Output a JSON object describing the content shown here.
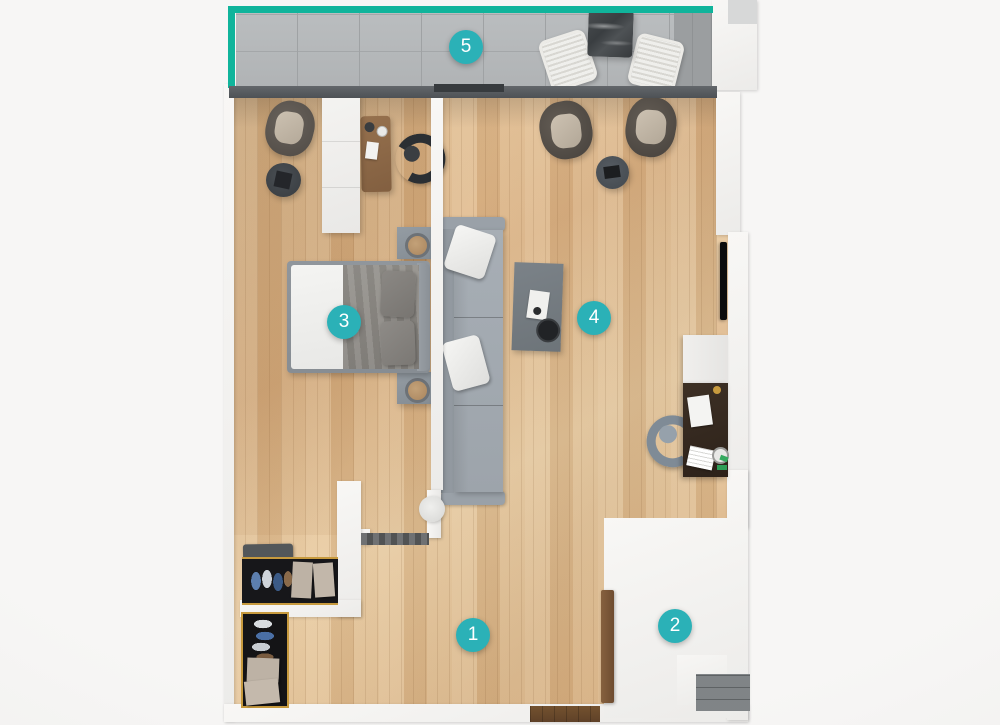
{
  "app": {
    "type": "apartment-floor-plan-render"
  },
  "badges": [
    {
      "number": "1",
      "area": "hallway"
    },
    {
      "number": "2",
      "area": "bathroom"
    },
    {
      "number": "3",
      "area": "bedroom"
    },
    {
      "number": "4",
      "area": "living-room"
    },
    {
      "number": "5",
      "area": "balcony"
    }
  ],
  "colors": {
    "badge_accent": "#2bb1b7",
    "balcony_edge": "#10b49b",
    "window_wall": "#53575a",
    "wood_floor": "#ddbb8f",
    "balcony_tile": "#b5b8ba",
    "bathroom_tile": "#a5a4a1",
    "wall": "#f4f3f1",
    "shoe_cabinet_trim": "#c79a3e"
  }
}
